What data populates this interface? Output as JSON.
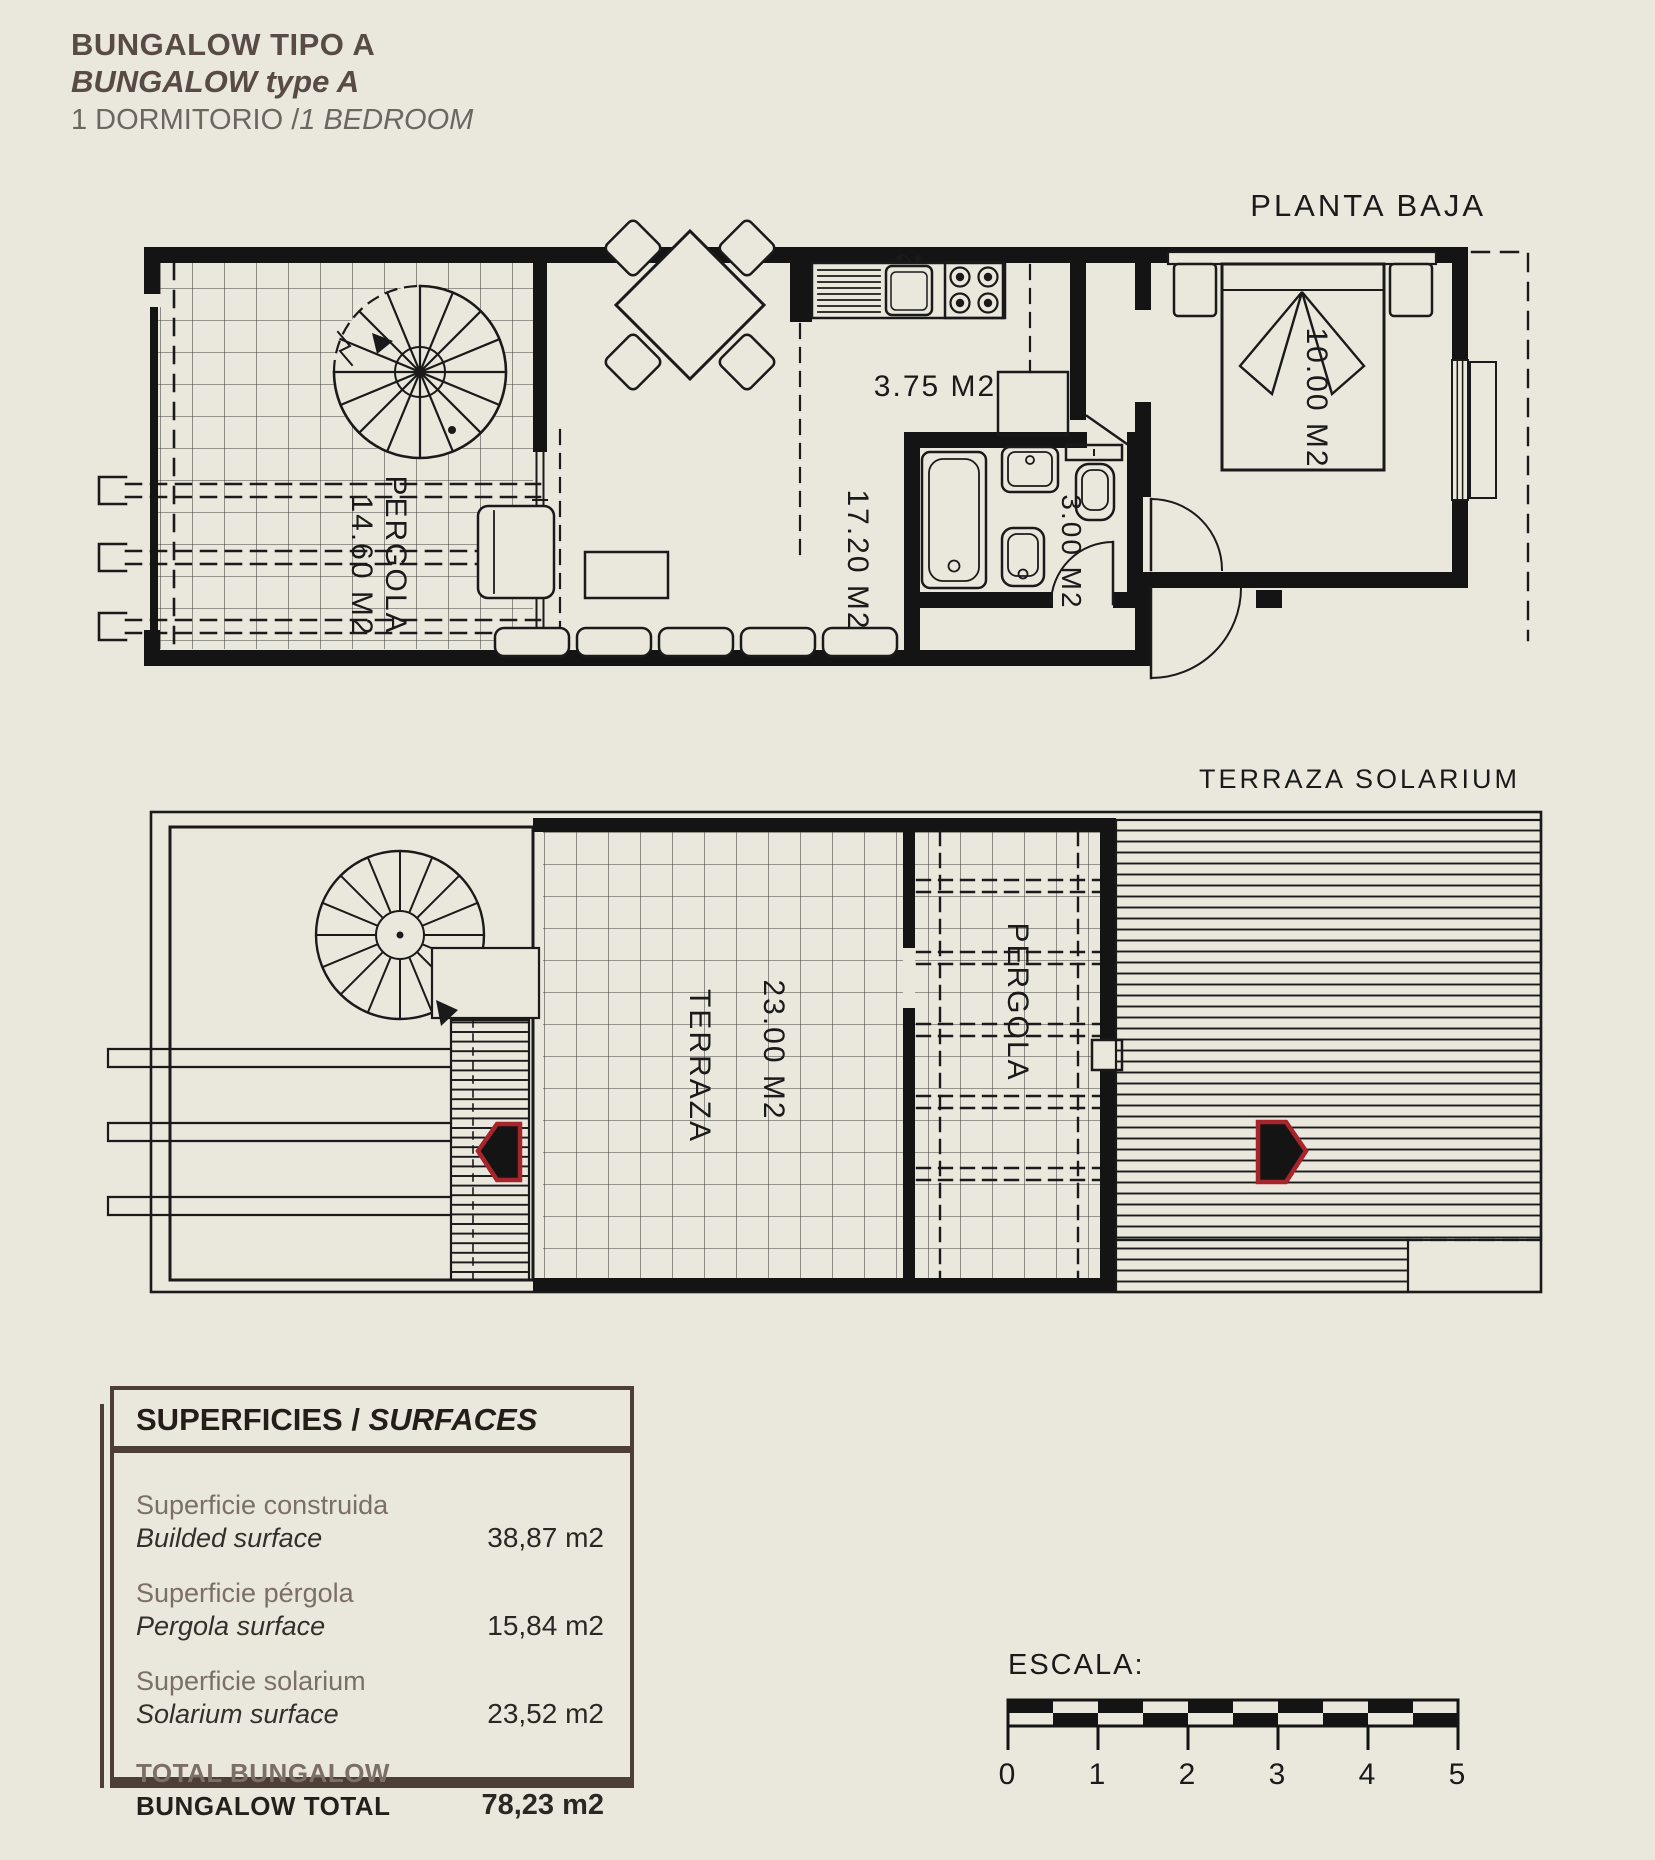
{
  "colors": {
    "background": "#eae8dd",
    "ink": "#1a1a1a",
    "accent_red": "#a8242b",
    "title_brown": "#584a44",
    "table_border": "#4d3e37"
  },
  "header": {
    "title_es": "BUNGALOW TIPO A",
    "title_en": "BUNGALOW type A",
    "subtitle_prefix": "1 DORMITORIO /",
    "subtitle_italic": "1 BEDROOM"
  },
  "ground_floor": {
    "title": "PLANTA BAJA",
    "labels": {
      "pergola_name": "PERGOLA",
      "pergola_area": "14.60 M2",
      "kitchen_area": "3.75 M2",
      "living_area": "17.20 M2",
      "bath_area": "3.00 M2",
      "bedroom_area": "10.00 M2"
    }
  },
  "roof_floor": {
    "title": "TERRAZA SOLARIUM",
    "labels": {
      "terraza_name": "TERRAZA",
      "terraza_area": "23.00 M2",
      "pergola_name": "PERGOLA"
    }
  },
  "surfaces": {
    "title_es": "SUPERFICIES /",
    "title_en": " SURFACES",
    "rows": [
      {
        "label_es": "Superficie construida",
        "label_en": "Builded surface",
        "value": "38,87 m2"
      },
      {
        "label_es": "Superficie pérgola",
        "label_en": "Pergola surface",
        "value": "15,84 m2"
      },
      {
        "label_es": "Superficie solarium",
        "label_en": "Solarium surface",
        "value": "23,52 m2"
      }
    ],
    "total_label_es": "TOTAL BUNGALOW",
    "total_label_en": "BUNGALOW TOTAL",
    "total_value": "78,23 m2"
  },
  "scale_bar": {
    "label": "ESCALA:",
    "ticks": [
      "0",
      "1",
      "2",
      "3",
      "4",
      "5"
    ]
  }
}
